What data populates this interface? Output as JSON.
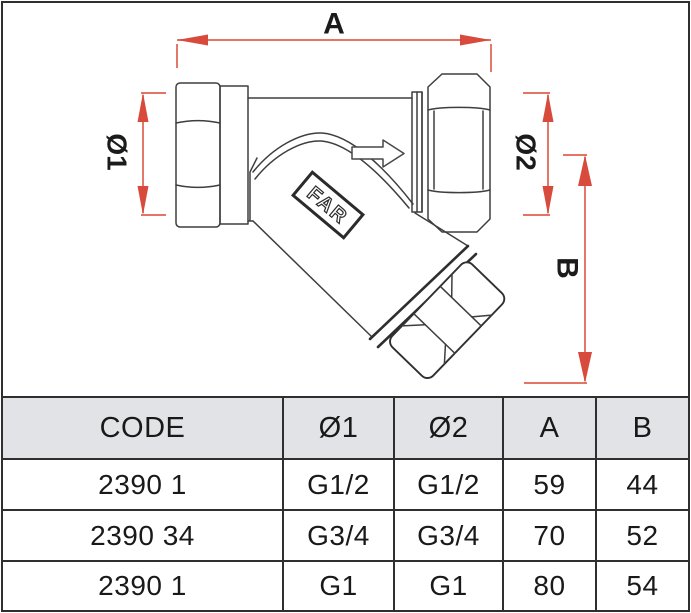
{
  "drawing": {
    "brand": "FAR",
    "labels": {
      "a": "A",
      "d1": "Ø1",
      "d2": "Ø2",
      "b": "B"
    },
    "flow_arrow_icon": "right-arrow",
    "colors": {
      "dimension_red": "#d84a3b",
      "line_dark": "#3e3e3e",
      "header_bg": "#e2e3e6"
    }
  },
  "table": {
    "headers": [
      "CODE",
      "Ø1",
      "Ø2",
      "A",
      "B"
    ],
    "rows": [
      {
        "cells": [
          "2390 1",
          "G1/2",
          "G1/2",
          "59",
          "44"
        ]
      },
      {
        "cells": [
          "2390 34",
          "G3/4",
          "G3/4",
          "70",
          "52"
        ]
      },
      {
        "cells": [
          "2390 1",
          "G1",
          "G1",
          "80",
          "54"
        ]
      }
    ]
  }
}
